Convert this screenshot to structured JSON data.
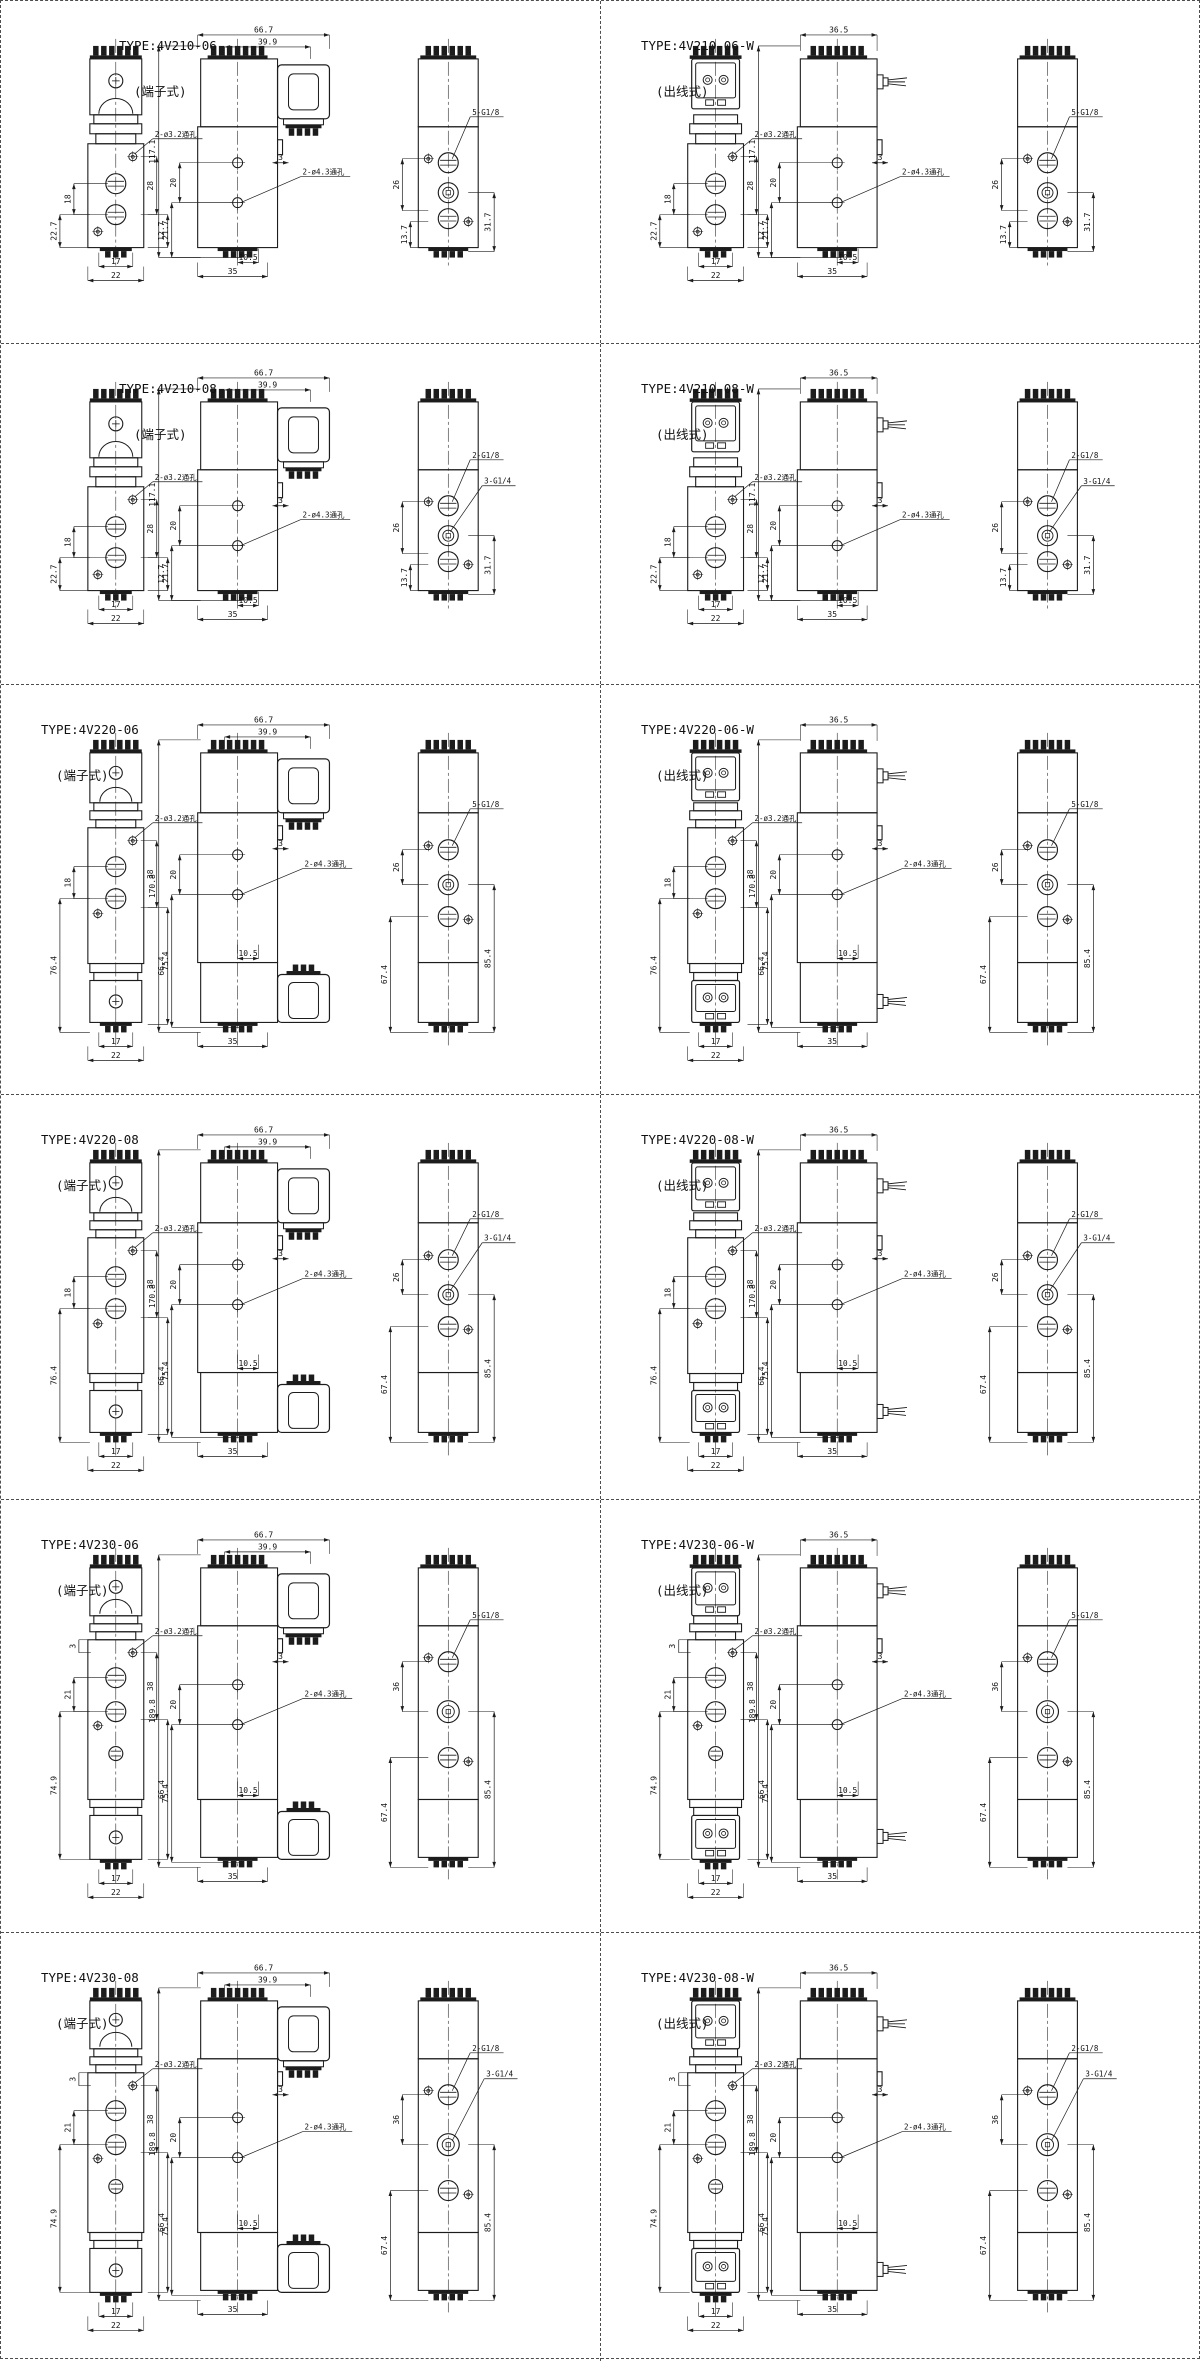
{
  "sheet": {
    "name": "4V200 series valve dimension drawings"
  },
  "panels": [
    {
      "title": "TYPE:4V210-06",
      "subtitle": "(端子式)",
      "style": "terminal",
      "kind": "single",
      "dims": {
        "top": [
          "66.7",
          "39.9"
        ],
        "height": "117.1",
        "front_left": [
          "18",
          "22.7"
        ],
        "front_right": [
          "28",
          "12.7"
        ],
        "front_bottom": [
          "17",
          "22"
        ],
        "mid_left": [
          "20",
          "21.7"
        ],
        "mid_bottom": [
          "10.5",
          "35"
        ],
        "mid_offset": "3",
        "side_left": [
          "26"
        ],
        "side_right": [
          "13.7",
          "31.7"
        ],
        "hole_front": "2-ø3.2通孔",
        "hole_mid": "2-ø4.3通孔",
        "ports": [
          "5-G1/8"
        ]
      }
    },
    {
      "title": "TYPE:4V210-06-W",
      "subtitle": "(出线式)",
      "style": "wire",
      "kind": "single",
      "dims": {
        "top": [
          "36.5"
        ],
        "height": "117.1",
        "front_left": [
          "18",
          "22.7"
        ],
        "front_right": [
          "28",
          "12.7"
        ],
        "front_bottom": [
          "17",
          "22"
        ],
        "mid_left": [
          "20",
          "21.7"
        ],
        "mid_bottom": [
          "10.5",
          "35"
        ],
        "mid_offset": "3",
        "side_left": [
          "26"
        ],
        "side_right": [
          "13.7",
          "31.7"
        ],
        "hole_front": "2-ø3.2通孔",
        "hole_mid": "2-ø4.3通孔",
        "ports": [
          "5-G1/8"
        ]
      }
    },
    {
      "title": "TYPE:4V210-08",
      "subtitle": "(端子式)",
      "style": "terminal",
      "kind": "single",
      "dims": {
        "top": [
          "66.7",
          "39.9"
        ],
        "height": "117.1",
        "front_left": [
          "18",
          "22.7"
        ],
        "front_right": [
          "28",
          "12.7"
        ],
        "front_bottom": [
          "17",
          "22"
        ],
        "mid_left": [
          "20",
          "21.7"
        ],
        "mid_bottom": [
          "10.5",
          "35"
        ],
        "mid_offset": "3",
        "side_left": [
          "26"
        ],
        "side_right": [
          "13.7",
          "31.7"
        ],
        "hole_front": "2-ø3.2通孔",
        "hole_mid": "2-ø4.3通孔",
        "ports": [
          "2-G1/8",
          "3-G1/4"
        ]
      }
    },
    {
      "title": "TYPE:4V210-08-W",
      "subtitle": "(出线式)",
      "style": "wire",
      "kind": "single",
      "dims": {
        "top": [
          "36.5"
        ],
        "height": "117.1",
        "front_left": [
          "18",
          "22.7"
        ],
        "front_right": [
          "28",
          "12.7"
        ],
        "front_bottom": [
          "17",
          "22"
        ],
        "mid_left": [
          "20",
          "21.7"
        ],
        "mid_bottom": [
          "10.5",
          "35"
        ],
        "mid_offset": "3",
        "side_left": [
          "26"
        ],
        "side_right": [
          "13.7",
          "31.7"
        ],
        "hole_front": "2-ø3.2通孔",
        "hole_mid": "2-ø4.3通孔",
        "ports": [
          "2-G1/8",
          "3-G1/4"
        ]
      }
    },
    {
      "title": "TYPE:4V220-06",
      "subtitle": "(端子式)",
      "style": "terminal",
      "kind": "double",
      "dims": {
        "top": [
          "66.7",
          "39.9"
        ],
        "height": "170.8",
        "front_left": [
          "18",
          "76.4"
        ],
        "front_right": [
          "38",
          "66.4"
        ],
        "front_bottom": [
          "17",
          "22"
        ],
        "mid_left": [
          "20",
          "75.4"
        ],
        "mid_bottom": [
          "10.5",
          "35"
        ],
        "mid_offset": "3",
        "side_left": [
          "26",
          "67.4"
        ],
        "side_right": [
          "85.4"
        ],
        "hole_front": "2-ø3.2通孔",
        "hole_mid": "2-ø4.3通孔",
        "ports": [
          "5-G1/8"
        ]
      }
    },
    {
      "title": "TYPE:4V220-06-W",
      "subtitle": "(出线式)",
      "style": "wire",
      "kind": "double",
      "dims": {
        "top": [
          "36.5"
        ],
        "height": "170.8",
        "front_left": [
          "18",
          "76.4"
        ],
        "front_right": [
          "38",
          "66.4"
        ],
        "front_bottom": [
          "17",
          "22"
        ],
        "mid_left": [
          "20",
          "75.4"
        ],
        "mid_bottom": [
          "10.5",
          "35"
        ],
        "mid_offset": "3",
        "side_left": [
          "26",
          "67.4"
        ],
        "side_right": [
          "85.4"
        ],
        "hole_front": "2-ø3.2通孔",
        "hole_mid": "2-ø4.3通孔",
        "ports": [
          "5-G1/8"
        ]
      }
    },
    {
      "title": "TYPE:4V220-08",
      "subtitle": "(端子式)",
      "style": "terminal",
      "kind": "double",
      "dims": {
        "top": [
          "66.7",
          "39.9"
        ],
        "height": "170.8",
        "front_left": [
          "18",
          "76.4"
        ],
        "front_right": [
          "38",
          "66.4"
        ],
        "front_bottom": [
          "17",
          "22"
        ],
        "mid_left": [
          "20",
          "75.4"
        ],
        "mid_bottom": [
          "10.5",
          "35"
        ],
        "mid_offset": "3",
        "side_left": [
          "26",
          "67.4"
        ],
        "side_right": [
          "85.4"
        ],
        "hole_front": "2-ø3.2通孔",
        "hole_mid": "2-ø4.3通孔",
        "ports": [
          "2-G1/8",
          "3-G1/4"
        ]
      }
    },
    {
      "title": "TYPE:4V220-08-W",
      "subtitle": "(出线式)",
      "style": "wire",
      "kind": "double",
      "dims": {
        "top": [
          "36.5"
        ],
        "height": "170.8",
        "front_left": [
          "18",
          "76.4"
        ],
        "front_right": [
          "38",
          "66.4"
        ],
        "front_bottom": [
          "17",
          "22"
        ],
        "mid_left": [
          "20",
          "75.4"
        ],
        "mid_bottom": [
          "10.5",
          "35"
        ],
        "mid_offset": "3",
        "side_left": [
          "26",
          "67.4"
        ],
        "side_right": [
          "85.4"
        ],
        "hole_front": "2-ø3.2通孔",
        "hole_mid": "2-ø4.3通孔",
        "ports": [
          "2-G1/8",
          "3-G1/4"
        ]
      }
    },
    {
      "title": "TYPE:4V230-06",
      "subtitle": "(端子式)",
      "style": "terminal",
      "kind": "triple",
      "dims": {
        "top": [
          "66.7",
          "39.9"
        ],
        "height": "189.8",
        "front_left": [
          "3",
          "21",
          "74.9"
        ],
        "front_right": [
          "38",
          "66.4"
        ],
        "front_bottom": [
          "17",
          "22"
        ],
        "mid_left": [
          "20",
          "75.4"
        ],
        "mid_bottom": [
          "10.5",
          "35"
        ],
        "mid_offset": "3",
        "side_left": [
          "36",
          "67.4"
        ],
        "side_right": [
          "85.4"
        ],
        "hole_front": "2-ø3.2通孔",
        "hole_mid": "2-ø4.3通孔",
        "ports": [
          "5-G1/8"
        ]
      }
    },
    {
      "title": "TYPE:4V230-06-W",
      "subtitle": "(出线式)",
      "style": "wire",
      "kind": "triple",
      "dims": {
        "top": [
          "36.5"
        ],
        "height": "189.8",
        "front_left": [
          "3",
          "21",
          "74.9"
        ],
        "front_right": [
          "38",
          "66.4"
        ],
        "front_bottom": [
          "17",
          "22"
        ],
        "mid_left": [
          "20",
          "75.4"
        ],
        "mid_bottom": [
          "10.5",
          "35"
        ],
        "mid_offset": "3",
        "side_left": [
          "36",
          "67.4"
        ],
        "side_right": [
          "85.4"
        ],
        "hole_front": "2-ø3.2通孔",
        "hole_mid": "2-ø4.3通孔",
        "ports": [
          "5-G1/8"
        ]
      }
    },
    {
      "title": "TYPE:4V230-08",
      "subtitle": "(端子式)",
      "style": "terminal",
      "kind": "triple",
      "dims": {
        "top": [
          "66.7",
          "39.9"
        ],
        "height": "189.8",
        "front_left": [
          "3",
          "21",
          "74.9"
        ],
        "front_right": [
          "38",
          "66.4"
        ],
        "front_bottom": [
          "17",
          "22"
        ],
        "mid_left": [
          "20",
          "75.4"
        ],
        "mid_bottom": [
          "10.5",
          "35"
        ],
        "mid_offset": "3",
        "side_left": [
          "36",
          "67.4"
        ],
        "side_right": [
          "85.4"
        ],
        "hole_front": "2-ø3.2通孔",
        "hole_mid": "2-ø4.3通孔",
        "ports": [
          "2-G1/8",
          "3-G1/4"
        ]
      }
    },
    {
      "title": "TYPE:4V230-08-W",
      "subtitle": "(出线式)",
      "style": "wire",
      "kind": "triple",
      "dims": {
        "top": [
          "36.5"
        ],
        "height": "189.8",
        "front_left": [
          "3",
          "21",
          "74.9"
        ],
        "front_right": [
          "38",
          "66.4"
        ],
        "front_bottom": [
          "17",
          "22"
        ],
        "mid_left": [
          "20",
          "75.4"
        ],
        "mid_bottom": [
          "10.5",
          "35"
        ],
        "mid_offset": "3",
        "side_left": [
          "36",
          "67.4"
        ],
        "side_right": [
          "85.4"
        ],
        "hole_front": "2-ø3.2通孔",
        "hole_mid": "2-ø4.3通孔",
        "ports": [
          "2-G1/8",
          "3-G1/4"
        ]
      }
    }
  ]
}
